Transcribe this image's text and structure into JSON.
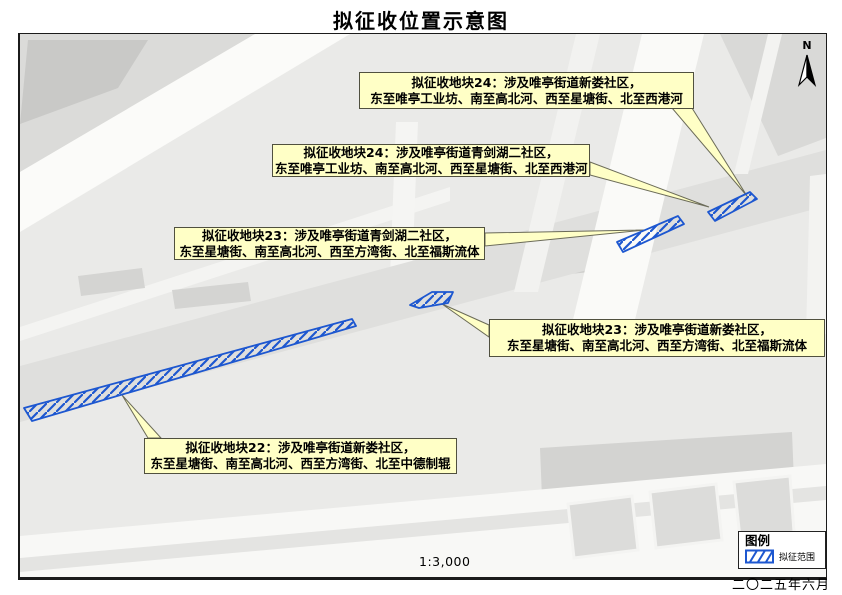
{
  "title": "拟征收位置示意图",
  "map": {
    "scale_label": "1:3,000",
    "north_label": "N",
    "date": "二〇二五年六月",
    "legend": {
      "title": "图例",
      "items": [
        {
          "symbol": "blue-diagonal-hatch",
          "label": "拟征范围"
        }
      ]
    },
    "callouts": [
      {
        "id": "block-24-xinlou",
        "line1": "拟征收地块24：涉及唯亭街道新娄社区，",
        "line2": "东至唯亭工业坊、南至高北河、西至星塘街、北至西港河"
      },
      {
        "id": "block-24-qingjianhu-2",
        "line1": "拟征收地块24：涉及唯亭街道青剑湖二社区，",
        "line2": "东至唯亭工业坊、南至高北河、西至星塘街、北至西港河"
      },
      {
        "id": "block-23-qingjianhu-2",
        "line1": "拟征收地块23：涉及唯亭街道青剑湖二社区，",
        "line2": "东至星塘街、南至高北河、西至方湾街、北至福斯流体"
      },
      {
        "id": "block-23-xinlou",
        "line1": "拟征收地块23：涉及唯亭街道新娄社区，",
        "line2": "东至星塘街、南至高北河、西至方湾街、北至福斯流体"
      },
      {
        "id": "block-22-xinlou",
        "line1": "拟征收地块22：涉及唯亭街道新娄社区，",
        "line2": "东至星塘街、南至高北河、西至方湾街、北至中德制辊"
      }
    ],
    "colors": {
      "hatch_blue": "#1d57d0",
      "callout_bg": "#FFFFC6",
      "callout_border": "#50503f",
      "map_base": "#EAEAE8"
    }
  }
}
